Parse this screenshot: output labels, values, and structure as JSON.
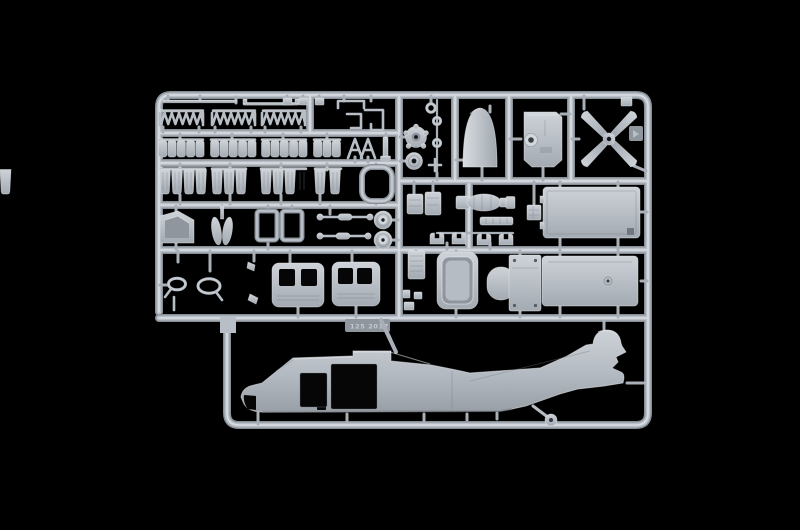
{
  "scene": {
    "type": "photograph",
    "description": "Light grey injection-molded polystyrene model kit sprue (parts frame) for a 1:72 UH-60 Black Hawk style helicopter, photographed on a pure black background. Upper portion is a grid of runners holding small detail parts; lower bay holds the right fuselage half with tail boom, rotor-hub dome and tail wheel.",
    "background_color": "#000000"
  },
  "colors": {
    "bg": "#000000",
    "runner_base": "#878e95",
    "runner_mid": "#b7bec5",
    "runner_hi": "#e2e6ea",
    "gate": "#a8afb6",
    "plastic_base": "#b6bcc3",
    "plastic_light": "#d3d8dd",
    "plastic_hi": "#e9edf0",
    "plastic_shadow": "#8f969d",
    "plastic_dark": "#70777e",
    "opening": "#060607",
    "emboss": "#ced3d8"
  },
  "sprue": {
    "embossed_marking": "125 2017",
    "material": "light grey styrene",
    "parts_inventory": [
      {
        "id": "antenna-rods",
        "count": 2
      },
      {
        "id": "troop-seat-frame-strips",
        "count": 3
      },
      {
        "id": "runner-clips",
        "count": 3
      },
      {
        "id": "bent-rod-parts",
        "count": 3
      },
      {
        "id": "seat-cushion-strips",
        "count": 4
      },
      {
        "id": "a-frame-braces",
        "count": 2
      },
      {
        "id": "seat-bucket-strips",
        "count": 4
      },
      {
        "id": "rounded-square-frame",
        "count": 1
      },
      {
        "id": "cockpit-side-panel",
        "count": 1
      },
      {
        "id": "blade-pair",
        "count": 1
      },
      {
        "id": "door-window-frames",
        "count": 2
      },
      {
        "id": "actuator-rods",
        "count": 2
      },
      {
        "id": "wheels",
        "count": 2
      },
      {
        "id": "rear-view-mirrors",
        "count": 2
      },
      {
        "id": "cabin-doors",
        "count": 2
      },
      {
        "id": "small-rings",
        "count": 2
      },
      {
        "id": "rotor-hub-disc",
        "count": 1
      },
      {
        "id": "pulley-disc",
        "count": 1
      },
      {
        "id": "nose-cone",
        "count": 1
      },
      {
        "id": "cockpit-bulkhead",
        "count": 1
      },
      {
        "id": "tail-rotor-four-blade",
        "count": 1
      },
      {
        "id": "avionics-boxes",
        "count": 2
      },
      {
        "id": "hoist-winch-assembly",
        "count": 1
      },
      {
        "id": "equipment-rack",
        "count": 1
      },
      {
        "id": "pipe-clamps",
        "count": 4
      },
      {
        "id": "louvered-vent-panel",
        "count": 1
      },
      {
        "id": "window-door-panel",
        "count": 1
      },
      {
        "id": "seat-bulkhead-panel",
        "count": 1
      },
      {
        "id": "cabin-roof-panel",
        "count": 1
      },
      {
        "id": "cabin-floor-panel",
        "count": 1
      },
      {
        "id": "fuselage-right-half",
        "count": 1
      },
      {
        "id": "tail-wheel",
        "count": 1
      }
    ]
  }
}
